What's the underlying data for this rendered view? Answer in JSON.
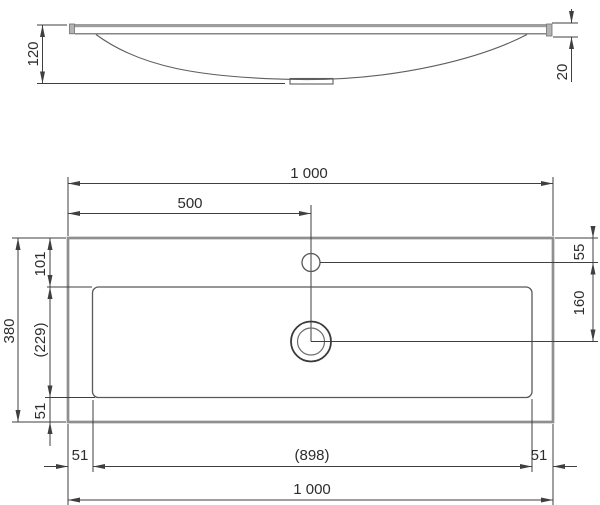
{
  "colors": {
    "dimension_line": "#3f3f3f",
    "object_line": "#585858",
    "thick_edge": "#8f8f8f",
    "text": "#2d2d2d"
  },
  "dims": {
    "side": {
      "height": "120",
      "edge": "20"
    },
    "plan": {
      "width_top": "1 000",
      "faucet_offset_x": "500",
      "faucet_offset_y": "55",
      "faucet_to_drain": "160",
      "depth": "380",
      "rim_top": "101",
      "basin_depth": "(229)",
      "rim_bottom_side": "51",
      "rim_left": "51",
      "basin_width": "(898)",
      "rim_right": "51",
      "width_bottom": "1 000"
    }
  }
}
